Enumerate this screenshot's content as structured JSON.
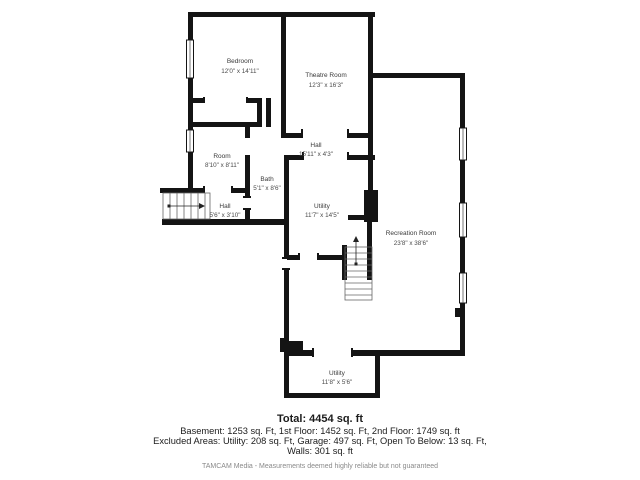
{
  "floor_plan": {
    "wall_color": "#141414",
    "rooms": {
      "bedroom": {
        "name": "Bedroom",
        "dims": "12'0\" x 14'11\""
      },
      "theatre": {
        "name": "Theatre Room",
        "dims": "12'3\" x 16'3\""
      },
      "hall_upper": {
        "name": "Hall",
        "dims": "15'11\" x 4'3\""
      },
      "room": {
        "name": "Room",
        "dims": "8'10\" x 8'11\""
      },
      "bath": {
        "name": "Bath",
        "dims": "5'1\" x 8'6\""
      },
      "hall_lower": {
        "name": "Hall",
        "dims": "5'6\" x 3'10\""
      },
      "utility_mid": {
        "name": "Utility",
        "dims": "11'7\" x 14'5\""
      },
      "recreation": {
        "name": "Recreation Room",
        "dims": "23'8\" x 38'6\""
      },
      "utility_bottom": {
        "name": "Utility",
        "dims": "11'8\" x 5'6\""
      }
    }
  },
  "footer": {
    "total": "Total: 4454 sq. ft",
    "line1": "Basement: 1253 sq. Ft, 1st Floor: 1452 sq. Ft, 2nd Floor: 1749 sq. ft",
    "line2": "Excluded Areas: Utility: 208 sq. Ft, Garage: 497 sq. Ft, Open To Below: 13 sq. Ft,",
    "line3": "Walls: 301 sq. ft",
    "disclaimer": "TAMCAM Media - Measurements deemed highly reliable but not guaranteed"
  }
}
